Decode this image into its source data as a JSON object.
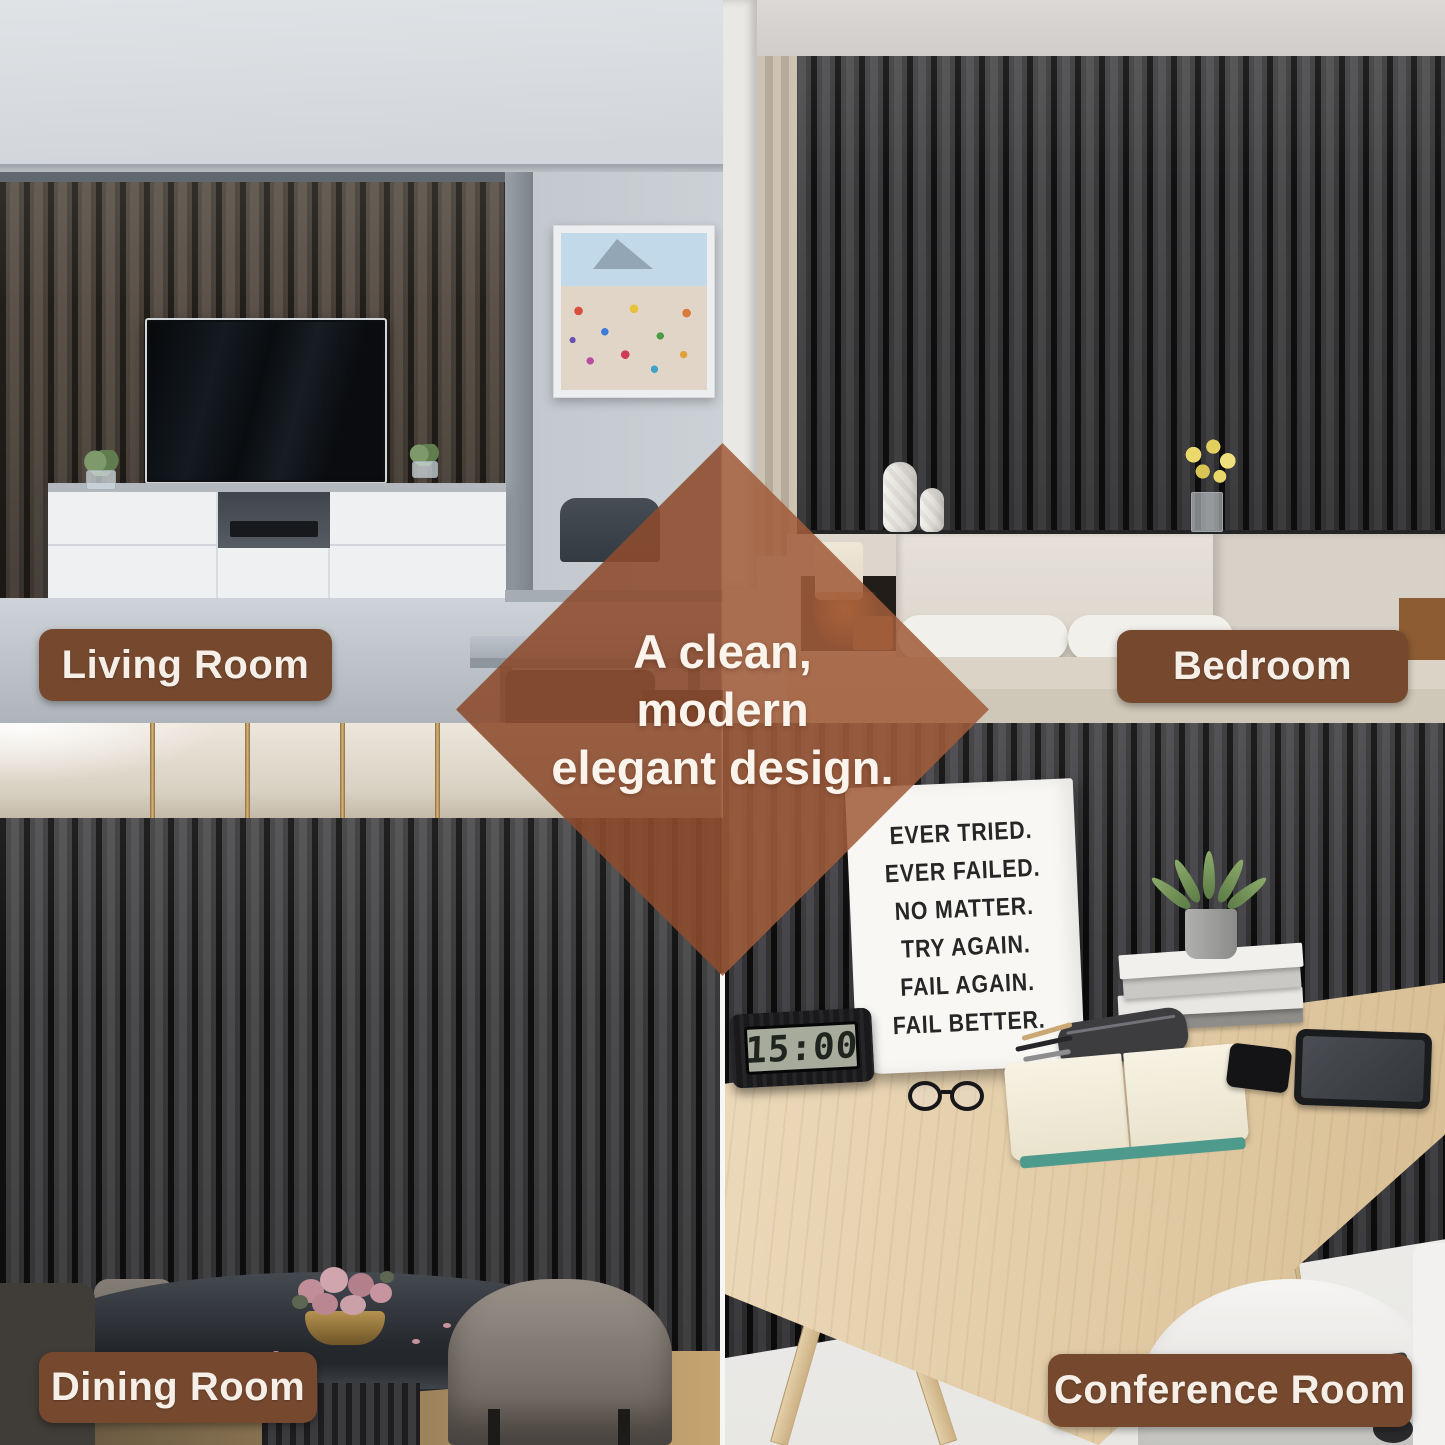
{
  "labels": {
    "living": "Living Room",
    "bedroom": "Bedroom",
    "dining": "Dining Room",
    "conference": "Conference Room"
  },
  "diamond": {
    "line1": "A clean,",
    "line2": "modern",
    "line3": "elegant design."
  },
  "poster": {
    "lines": [
      "EVER TRIED.",
      "EVER FAILED.",
      "NO MATTER.",
      "TRY AGAIN.",
      "FAIL AGAIN.",
      "FAIL BETTER."
    ]
  },
  "clock": {
    "time": "15:00"
  },
  "colors": {
    "label_background": "#76492f",
    "diamond_overlay": "#9a5a3a",
    "label_text": "#f6efe7",
    "slat_face": "#46464a",
    "slat_gap": "#101011"
  }
}
